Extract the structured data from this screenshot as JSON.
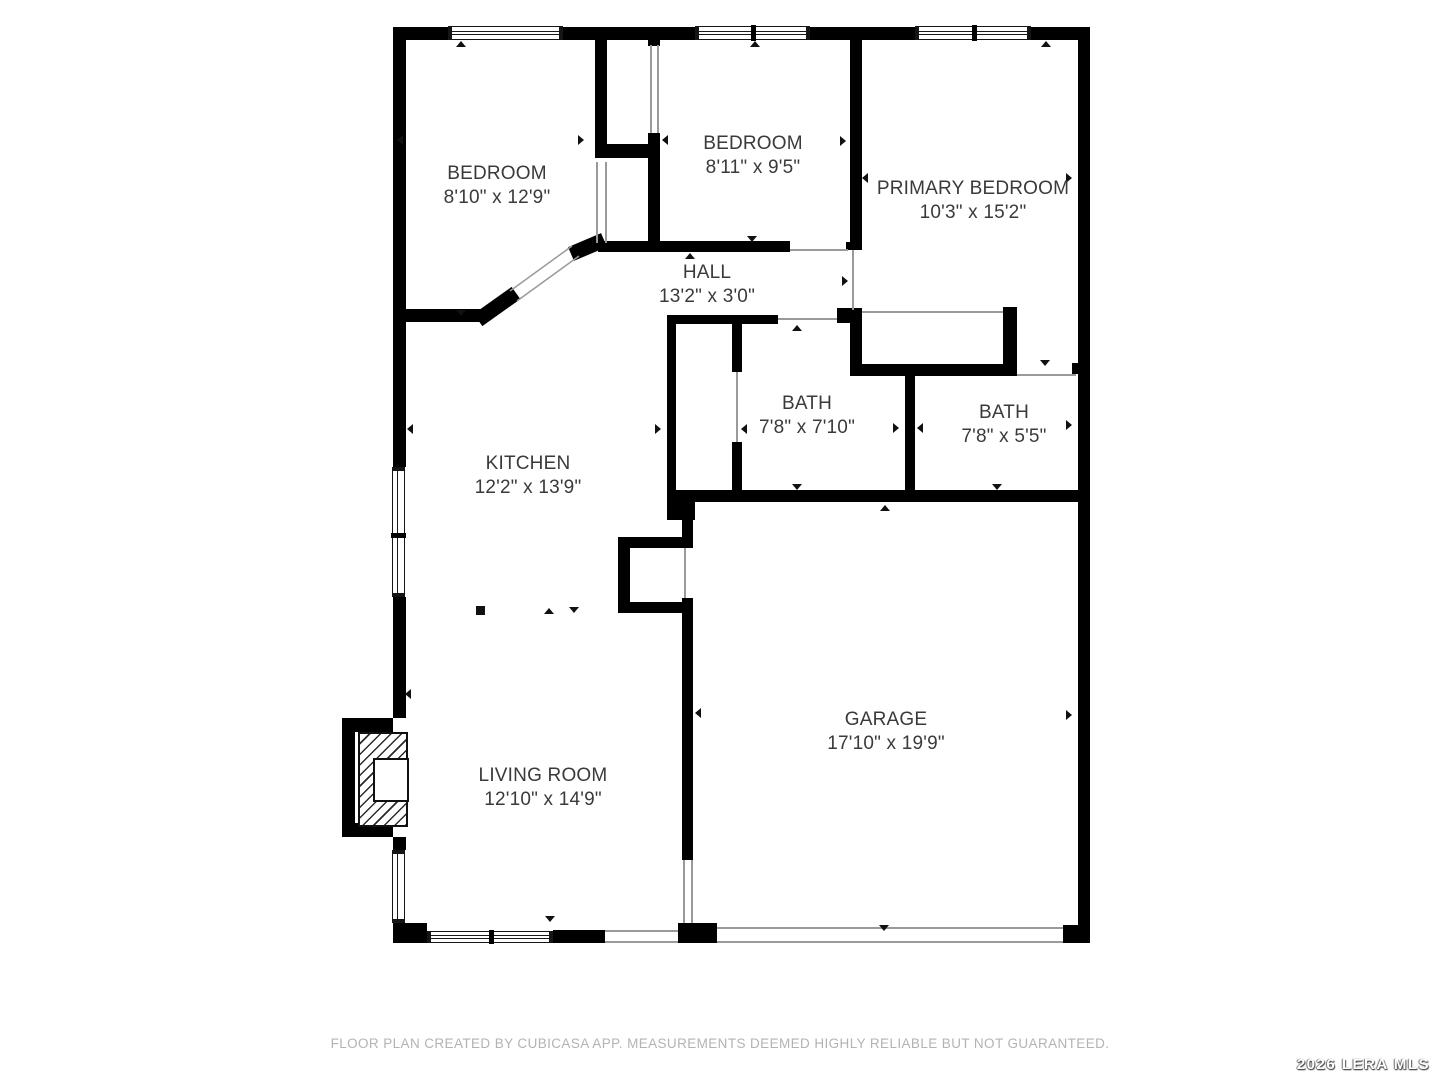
{
  "plan": {
    "rooms": [
      {
        "name": "BEDROOM",
        "dims": "8'10\" x 12'9\""
      },
      {
        "name": "BEDROOM",
        "dims": "8'11\" x 9'5\""
      },
      {
        "name": "PRIMARY BEDROOM",
        "dims": "10'3\" x 15'2\""
      },
      {
        "name": "HALL",
        "dims": "13'2\" x 3'0\""
      },
      {
        "name": "BATH",
        "dims": "7'8\" x 7'10\""
      },
      {
        "name": "BATH",
        "dims": "7'8\" x 5'5\""
      },
      {
        "name": "KITCHEN",
        "dims": "12'2\" x 13'9\""
      },
      {
        "name": "GARAGE",
        "dims": "17'10\" x 19'9\""
      },
      {
        "name": "LIVING ROOM",
        "dims": "12'10\" x 14'9\""
      }
    ],
    "footer": "FLOOR PLAN CREATED BY CUBICASA APP. MEASUREMENTS DEEMED HIGHLY RELIABLE BUT NOT GUARANTEED.",
    "watermark": "2026 LERA MLS",
    "colors": {
      "wall": "#000000",
      "label_text": "#3a3a3a",
      "footer_text": "#b3b3b3",
      "watermark_text": "#ffffff",
      "background": "#ffffff"
    }
  }
}
